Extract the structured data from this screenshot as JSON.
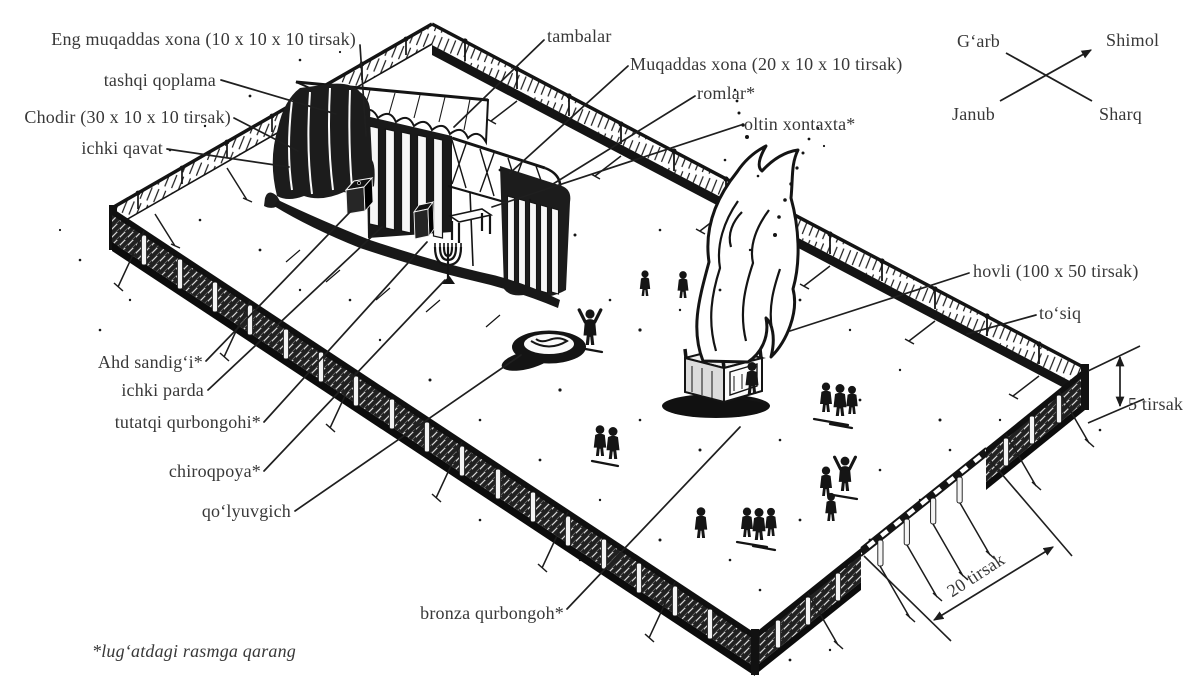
{
  "diagram": {
    "labels": {
      "eng_muqaddas_xona": "Eng muqaddas xona (10 x 10 x 10 tirsak)",
      "tashqi_qoplama": "tashqi qoplama",
      "chodir": "Chodir (30 x 10 x 10 tirsak)",
      "ichki_qavat": "ichki qavat",
      "tambalar": "tambalar",
      "muqaddas_xona": "Muqaddas xona (20 x 10 x 10 tirsak)",
      "romlar": "romlar*",
      "oltin_xontaxta": "oltin xontaxta*",
      "ahd_sandigi": "Ahd sandig‘i*",
      "ichki_parda": "ichki parda",
      "tutatqi_qurbongohi": "tutatqi qurbongohi*",
      "chiroqpoya": "chiroqpoya*",
      "qolyuvgich": "qo‘lyuvgich",
      "bronza_qurbongoh": "bronza qurbongoh*",
      "hovli": "hovli (100 x 50 tirsak)",
      "tosiq": "to‘siq",
      "fence_height": "5 tirsak",
      "gate_width": "20 tirsak"
    },
    "compass": {
      "west": "G‘arb",
      "north": "Shimol",
      "south": "Janub",
      "east": "Sharq"
    },
    "footnote": "*lug‘atdagi rasmga qarang",
    "colors": {
      "ink": "#1c1c1c",
      "text": "#383838",
      "background": "#ffffff"
    }
  }
}
